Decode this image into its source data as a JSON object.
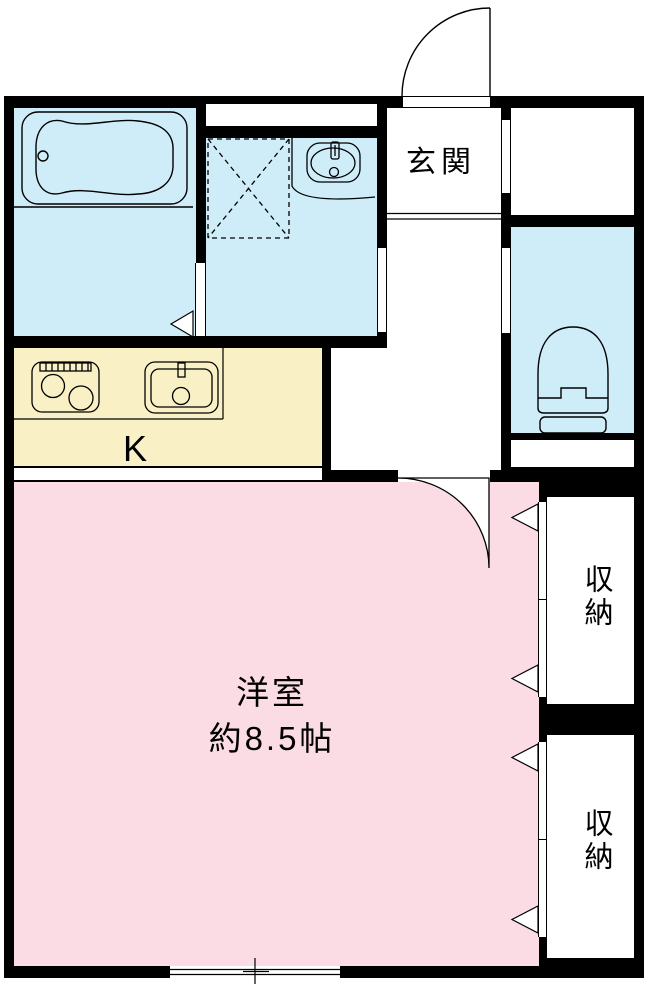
{
  "colors": {
    "wall_black": "#000000",
    "wet_area_blue": "#CFEDF9",
    "kitchen_yellow": "#FAF0C6",
    "room_pink": "#FBDBE4",
    "line_black": "#000000",
    "floor_white": "#FFFFFF"
  },
  "rooms": {
    "genkan": {
      "label": "玄関"
    },
    "kitchen": {
      "label": "K"
    },
    "western_room": {
      "label_line1": "洋室",
      "label_line2": "約8.5帖"
    },
    "storage_upper": {
      "label": "収納"
    },
    "storage_lower": {
      "label": "収納"
    }
  },
  "fixtures": [
    "bathtub",
    "shower-pan",
    "washbasin",
    "toilet",
    "gas-stove",
    "kitchen-sink",
    "entrance-door",
    "interior-door",
    "closet-folding-doors",
    "sliding-window"
  ]
}
